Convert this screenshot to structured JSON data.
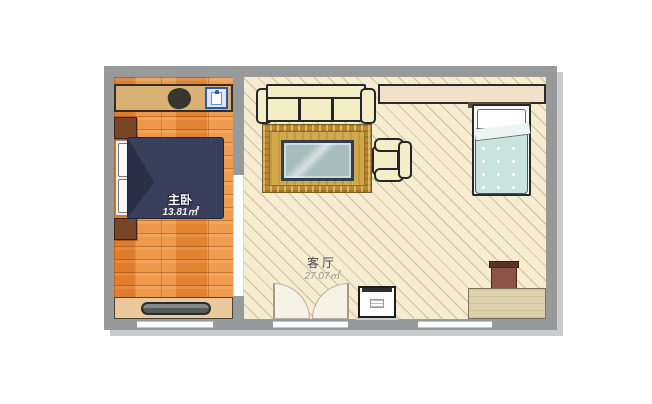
{
  "floorplan": {
    "rooms": [
      {
        "id": "bedroom",
        "name": "主卧",
        "area": "13.81㎡"
      },
      {
        "id": "living-room",
        "name": "客厅",
        "area": "27.07㎡"
      }
    ],
    "colors": {
      "wall_gray": "#97999b",
      "wall_shadow": "#c9cbcd",
      "bedroom_floor_orange": "#e98b3d",
      "living_floor_cream": "#f5ecd2",
      "living_floor_hatch": "#d9c9a2",
      "double_bed_duvet_navy": "#3a3f5c",
      "single_bed_duvet_mint": "#c9e4df",
      "rug_gold": "#c49539",
      "coffee_table_glass": "#a9bdbd",
      "sofa_cream": "#f4eec6",
      "wardrobe_tan": "#d9b175",
      "nightstand_brown": "#7a4527",
      "stool_brown": "#8d5247",
      "desk_tan": "#ddd0ad",
      "shirt_icon_blue": "#2a5aa8"
    },
    "furniture": [
      "wardrobe",
      "jacket-icon",
      "shirt-icon",
      "nightstand-upper",
      "nightstand-lower",
      "double-bed",
      "tv-cabinet",
      "tv",
      "sofa",
      "wall-shelf",
      "single-bed",
      "area-rug",
      "coffee-table",
      "armchair",
      "double-swing-door",
      "washing-machine",
      "stool",
      "desk"
    ]
  }
}
